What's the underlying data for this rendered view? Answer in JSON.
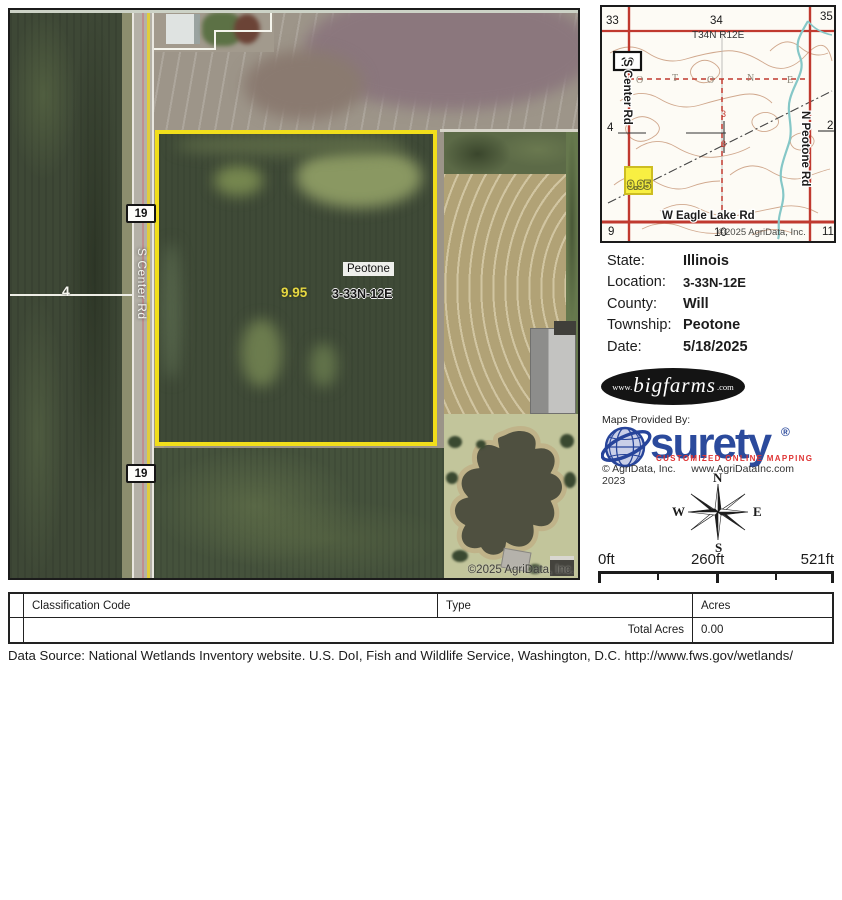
{
  "main_map": {
    "top_route_marker": "19",
    "bottom_route_marker": "19",
    "section_number": "4",
    "road_label": "S Center Rd",
    "town_label": "Peotone",
    "acres_label": "9.95",
    "location_label": "3-33N-12E",
    "copyright": "©2025 AgriData, Inc."
  },
  "inset_map": {
    "section_numbers": {
      "top_left": "33",
      "top_center": "34",
      "top_right": "35",
      "mid_left": "4",
      "mid_right": "2",
      "center_top": "3",
      "center_bottom": "3",
      "bottom_left": "9",
      "bottom_center": "10",
      "bottom_right": "11"
    },
    "township_range": "T34N R12E",
    "route_marker": "19",
    "road_center": "S Center Rd",
    "road_peotone": "N Peotone Rd",
    "road_eagle": "W Eagle Lake Rd",
    "parcel_acres": "9.95",
    "township_letters": [
      "O",
      "T",
      "O",
      "N",
      "E"
    ],
    "copyright": "©2025 AgriData, Inc."
  },
  "info_panel": {
    "rows": [
      {
        "label": "State:",
        "value": "Illinois"
      },
      {
        "label": "Location:",
        "value": "3-33N-12E"
      },
      {
        "label": "County:",
        "value": "Will"
      },
      {
        "label": "Township:",
        "value": "Peotone"
      },
      {
        "label": "Date:",
        "value": "5/18/2025"
      }
    ]
  },
  "branding": {
    "bigfarms_prefix": "www.",
    "bigfarms_name": "bigfarms",
    "bigfarms_suffix": ".com",
    "maps_provided_by": "Maps Provided By:",
    "surety_name": "surety",
    "surety_registered": "®",
    "surety_tagline": "CUSTOMIZED ONLINE MAPPING",
    "surety_copyright": "© AgriData, Inc. 2023",
    "surety_website": "www.AgriDataInc.com"
  },
  "compass": {
    "north": "N",
    "south": "S",
    "east": "E",
    "west": "W"
  },
  "scale_bar": {
    "start": "0ft",
    "middle": "260ft",
    "end": "521ft"
  },
  "legend_table": {
    "col_headers": [
      "Classification Code",
      "Type",
      "Acres"
    ],
    "total_label": "Total Acres",
    "total_value": "0.00"
  },
  "footer": {
    "data_source": "Data Source: National Wetlands Inventory website. U.S. DoI, Fish and Wildlife Service, Washington, D.C. http://www.fws.gov/wetlands/"
  },
  "colors": {
    "parcel_outline": "#f1de1b",
    "highlight_yellow": "#f8ef42",
    "road_red": "#c0392f",
    "stream_teal": "#85c7c7",
    "contour_tan": "#c99a7c",
    "surety_blue": "#2b4a9c",
    "surety_red": "#df3434"
  }
}
